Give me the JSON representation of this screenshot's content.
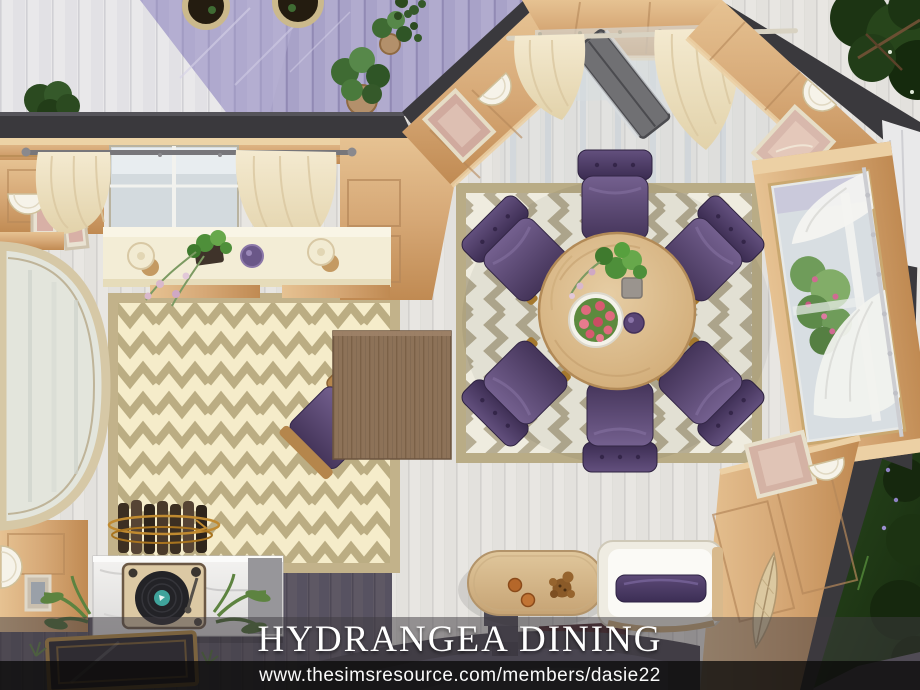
{
  "overlay": {
    "title": "HYDRANGEA DINING",
    "url": "www.thesimsresource.com/members/dasie22"
  },
  "palette": {
    "wall_top_dark": "#3a393d",
    "wood_light": "#e8c897",
    "wood_mid": "#d6a876",
    "wood_dark": "#c08a52",
    "floor_plank_white": "#e8e6e2",
    "patio_floor_purple": "#5e5864",
    "deck_lavender": "#a8a2c8",
    "deck_white": "#e9e8ea",
    "rug_left_cream": "#f5ecca",
    "rug_right_white": "#efecdf",
    "rug_zigzag_tan": "#b1a277",
    "chair_purple": "#46345c",
    "table_oak": "#d9b886",
    "curtain_cream": "#efe3c2",
    "marble_white": "#f0efed",
    "vinyl_black": "#232327",
    "vinyl_label_teal": "#3fa39b",
    "yard_green": "#24421a",
    "rose_pink": "#e06a7e"
  },
  "scene": {
    "room_name": "Hydrangea Dining",
    "objects": [
      "lavender-deck",
      "deck-potted-plants",
      "cream-chevron-rug",
      "gray-chevron-rug",
      "round-oak-dining-table",
      "six-purple-tufted-chairs",
      "rose-bowl-centerpiece",
      "potted-ivy-centerpiece",
      "purple-vase",
      "window-seat-console",
      "candles",
      "trailing-plant",
      "purple-bowl",
      "square-wood-desk",
      "purple-desk-chair",
      "firewood-bundle",
      "arched-floor-mirror",
      "wall-sconces",
      "framed-artwork",
      "cream-curtains",
      "gray-french-door",
      "picture-window-sheer-curtains",
      "marble-sideboard",
      "record-player",
      "palm-fronds",
      "brass-glass-coffee-table",
      "white-loveseat-purple-pillow",
      "oval-coffee-table",
      "cocoa-cups-and-gingerbread",
      "curved-garden-steps",
      "backyard-trees-and-lawn"
    ]
  }
}
